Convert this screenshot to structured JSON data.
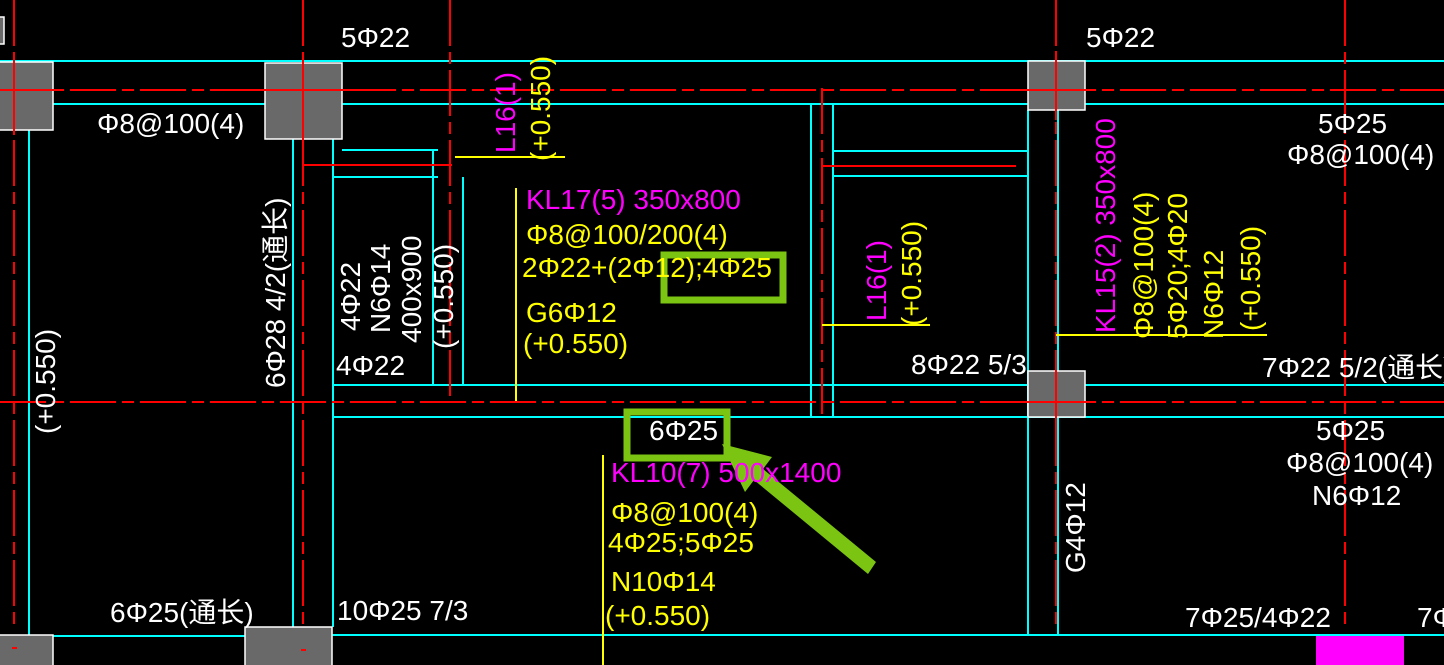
{
  "drawing": {
    "type": "structural-beam-plan",
    "colors": {
      "background": "#000000",
      "grid_red": "#ff0000",
      "beam_cyan": "#00ffff",
      "callout_yellow": "#ffff00",
      "beam_id_magenta": "#ff00ff",
      "text_white": "#ffffff",
      "column_gray": "#696969",
      "highlight_green": "#7cc412"
    },
    "texts": {
      "top_left_span": "5Φ22",
      "top_left_stirrup": "Φ8@100(4)",
      "top_right_span": "5Φ22",
      "right_top_span": "5Φ25",
      "right_top_stirrup": "Φ8@100(4)",
      "left_elevation": "(+0.550)",
      "left_beam_bars": "6Φ28 4/2(通长)",
      "vbeam_bars_top": "4Φ22",
      "vbeam_n_bars": "N6Φ14",
      "vbeam_size": "400x900",
      "vbeam_elevation": "(+0.550)",
      "vbeam_bars_bottom": "4Φ22",
      "l16_top_label": "L16(1)",
      "l16_top_elevation": "(+0.550)",
      "kl17_title": "KL17(5) 350x800",
      "kl17_stirrup": "Φ8@100/200(4)",
      "kl17_top_bars": "2Φ22+(2Φ12);4Φ25",
      "kl17_side_bars": "G6Φ12",
      "kl17_elevation": "(+0.550)",
      "l16_mid_label": "L16(1)",
      "l16_mid_elevation": "(+0.550)",
      "mid_support_bars": "8Φ22 5/3",
      "kl15_title": "KL15(2) 350x800",
      "kl15_stirrup": "Φ8@100(4)",
      "kl15_bars": "5Φ20;4Φ20",
      "kl15_n_bars": "N6Φ12",
      "kl15_elevation": "(+0.550)",
      "right_support_bars": "7Φ22 5/2(通长)",
      "highlight_mid_bars": "6Φ25",
      "kl10_title": "KL10(7) 500x1400",
      "kl10_stirrup": "Φ8@100(4)",
      "kl10_bars": "4Φ25;5Φ25",
      "kl10_n_bars": "N10Φ14",
      "kl10_elevation": "(+0.550)",
      "right_mid_span": "5Φ25",
      "right_mid_stirrup": "Φ8@100(4)",
      "right_mid_n_bars": "N6Φ12",
      "g4_side_bars": "G4Φ12",
      "bottom_left_bars": "6Φ25(通长)",
      "bottom_mid_bars": "10Φ25 7/3",
      "bottom_right_bars": "7Φ25/4Φ22",
      "bottom_edge_clipped": "7Φ2"
    }
  }
}
